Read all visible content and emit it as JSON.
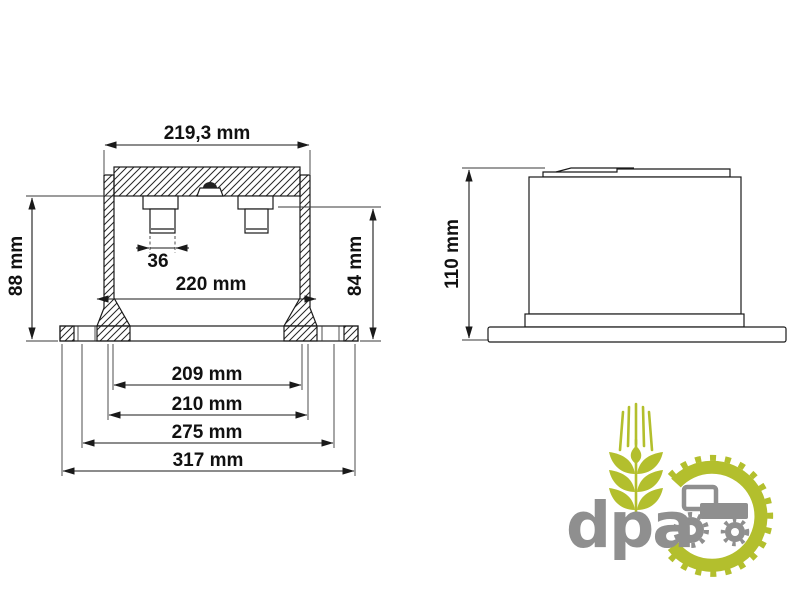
{
  "drawing": {
    "front_view": {
      "outer_width": "219,3 mm",
      "spigot_width": "36",
      "wall_outer_width": "220 mm",
      "height_left": "88 mm",
      "height_right": "84 mm",
      "bottom_width_1": "209 mm",
      "bottom_width_2": "210 mm",
      "bottom_width_3": "275 mm",
      "bottom_width_4": "317 mm"
    },
    "side_view": {
      "height": "110 mm"
    }
  },
  "logo": {
    "wordmark": "dpa",
    "colors": {
      "green": "#b3bf2d",
      "gray": "#8f8f8f"
    }
  }
}
